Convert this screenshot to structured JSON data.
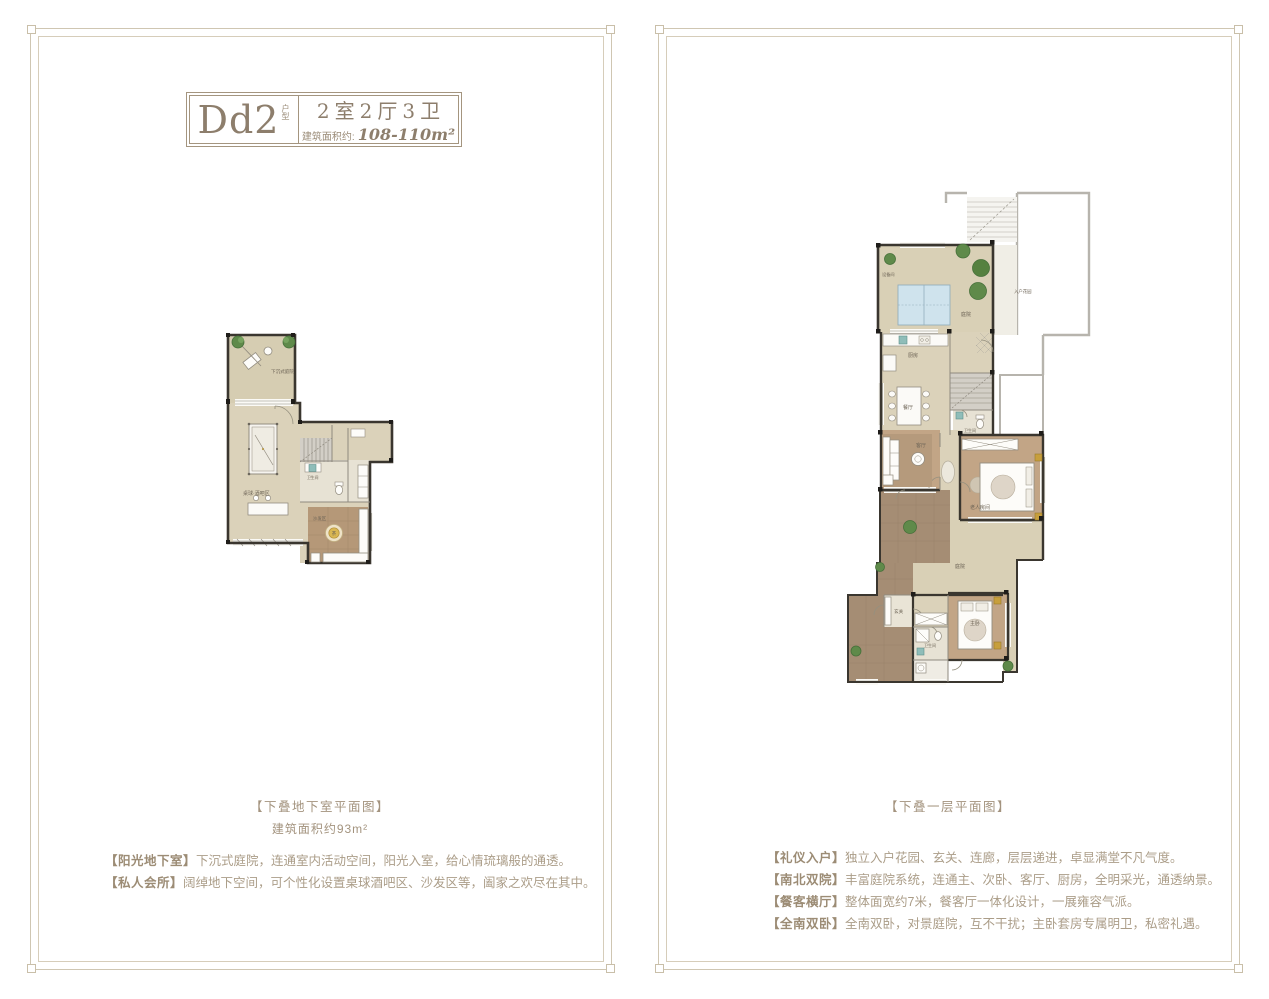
{
  "sheet": {
    "frame_color": "#cfc6b2",
    "accent_color": "#8d7e6c",
    "wall_color": "#3a362f",
    "floor_color": "#dbd2ba",
    "wood_color": "#c2a586",
    "tile_color": "#a58d74",
    "glass_color": "#cfe3ed",
    "tree_color": "#5f8a4a",
    "gold_color": "#c79f3d"
  },
  "left_panel": {
    "header": {
      "model": "Dd2",
      "model_tag": "户型",
      "rooms_spec": "2室2厅3卫",
      "area_label": "建筑面积约:",
      "area_value": "108-110m²"
    },
    "plan_rooms": {
      "courtyard": "下沉式庭院",
      "billiards": "桌球·酒吧区",
      "bath": "卫生间",
      "sofa": "沙发区",
      "tea": "茶"
    },
    "caption": "【下叠地下室平面图】",
    "caption_area": "建筑面积约93m²",
    "features": [
      {
        "title": "【阳光地下室】",
        "text": "下沉式庭院，连通室内活动空间，阳光入室，给心情琉璃般的通透。"
      },
      {
        "title": "【私人会所】",
        "text": "阔绰地下空间，可个性化设置桌球酒吧区、沙发区等，阖家之欢尽在其中。"
      }
    ]
  },
  "right_panel": {
    "plan_rooms": {
      "equipment": "设备间",
      "north_yard": "庭院",
      "entry_garden": "入户花园",
      "kitchen": "厨房",
      "dining": "餐厅",
      "living": "客厅",
      "bath1": "卫生间",
      "elder": "老人房间",
      "south_yard": "庭院",
      "foyer": "玄关",
      "master": "主卧",
      "bath2": "卫生间"
    },
    "caption": "【下叠一层平面图】",
    "features": [
      {
        "title": "【礼仪入户】",
        "text": "独立入户花园、玄关、连廊，层层递进，卓显满堂不凡气度。"
      },
      {
        "title": "【南北双院】",
        "text": "丰富庭院系统，连通主、次卧、客厅、厨房，全明采光，通透纳景。"
      },
      {
        "title": "【餐客横厅】",
        "text": "整体面宽约7米，餐客厅一体化设计，一展雍容气派。"
      },
      {
        "title": "【全南双卧】",
        "text": "全南双卧，对景庭院，互不干扰；主卧套房专属明卫，私密礼遇。"
      }
    ]
  }
}
